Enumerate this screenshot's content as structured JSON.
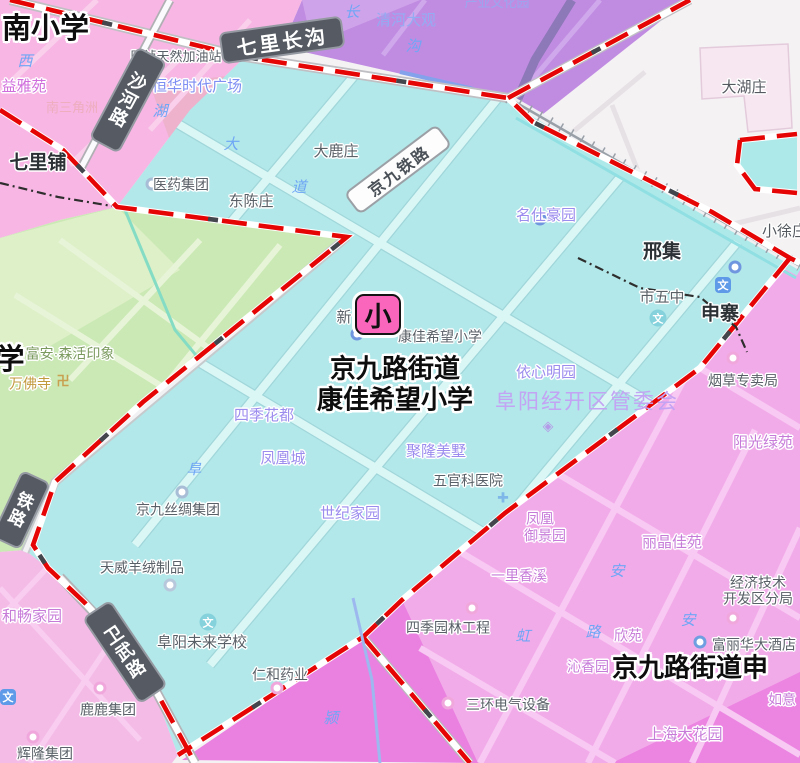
{
  "marker": {
    "text": "小"
  },
  "district_label": {
    "line1": "京九路街道",
    "line2": "康佳希望小学"
  },
  "big_labels": {
    "top_left": "南小学",
    "left": "学",
    "bottom_right": "京九路街道申"
  },
  "road_pills": {
    "qilichanggou": "七里长沟",
    "jingjiutielu": "京九铁路",
    "shahelu": [
      "沙",
      "河",
      "路"
    ],
    "weiwulu": [
      "卫",
      "武",
      "路"
    ],
    "tielu": [
      "铁",
      "路"
    ]
  },
  "labels": [
    "七里铺",
    "邢集",
    "申寨",
    "小徐庄",
    "大湖庄",
    "大鹿庄",
    "东陈庄",
    "医药集团",
    "国祯天然加油站",
    "恒华时代广场",
    "清河大观",
    "产业文化园",
    "益雅苑",
    "南三角洲",
    "名仕豪园",
    "康佳希望小学",
    "新",
    "依心明园",
    "阜阳经开区管委会",
    "烟草专卖局",
    "阳光绿苑",
    "四季花都",
    "凤凰城",
    "聚隆美墅",
    "五官科医院",
    "世纪家园",
    "京九丝绸集团",
    "天威羊绒制品",
    "和畅家园",
    "阜阳未来学校",
    "仁和药业",
    "鹿鹿集团",
    "辉隆集团",
    "四季园林工程",
    "三环电气设备",
    "沁香园",
    "欣苑",
    "如意",
    "上海大花园",
    "经济技术",
    "开发区分局",
    "富丽华大酒店",
    "丽晶佳苑",
    "凤凰",
    "御景园",
    "一里香溪",
    "市五中",
    "富安·森活印象",
    "万佛寺"
  ],
  "road_chars": [
    "西",
    "长",
    "沟",
    "湖",
    "大",
    "道",
    "阜",
    "颍",
    "安",
    "安",
    "虹",
    "路"
  ],
  "icons": {
    "school_glyph": "文",
    "hospital_glyph": "✚",
    "temple_glyph": "卍",
    "gov_glyph": "◈"
  },
  "colors": {
    "district_fill": "#b2e8e9",
    "boundary_red": "#e60505",
    "marker_pink": "#f966bb",
    "pink_area": "#f7b6e3",
    "magenta_area": "#f2abe9",
    "purple_area": "#c08ce2",
    "green_area": "#cbe9b5",
    "white_area": "#f5f2f4"
  }
}
